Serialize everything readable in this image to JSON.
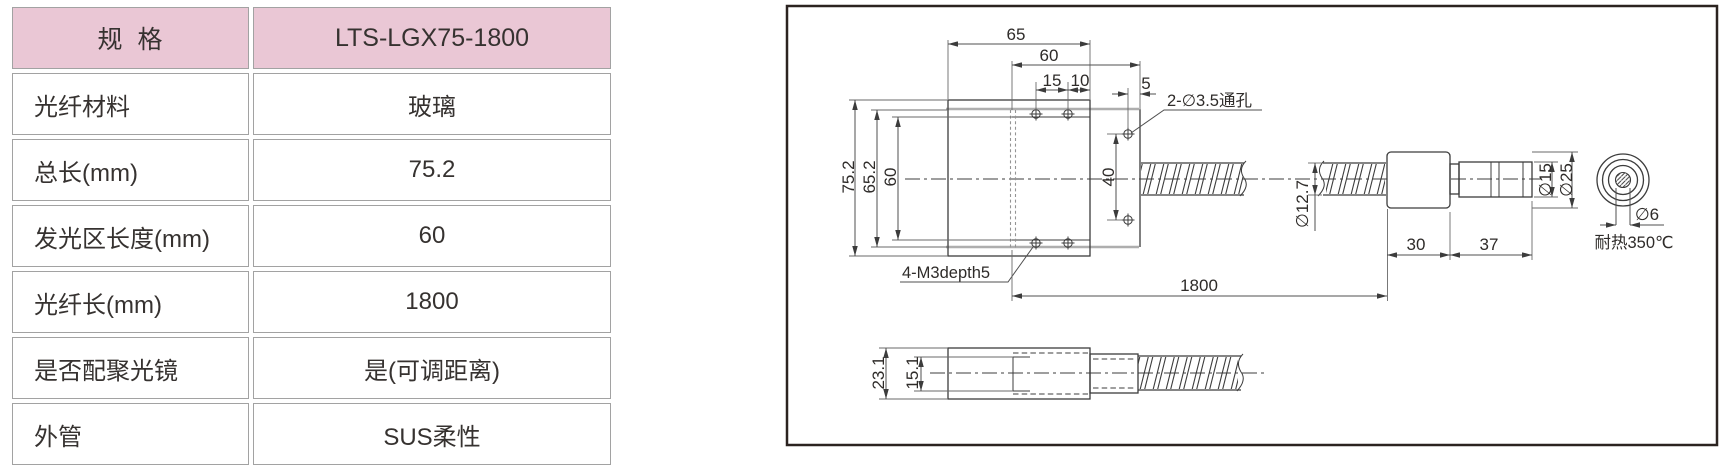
{
  "table": {
    "header_bg": "#eac7d5",
    "header": {
      "label": "规格",
      "value": "LTS-LGX75-1800"
    },
    "rows": [
      {
        "label": "光纤材料",
        "value": "玻璃"
      },
      {
        "label": "总长(mm)",
        "value": "75.2"
      },
      {
        "label": "发光区长度(mm)",
        "value": "60"
      },
      {
        "label": "光纤长(mm)",
        "value": "1800"
      },
      {
        "label": "是否配聚光镜",
        "value": "是(可调距离)"
      },
      {
        "label": "外管",
        "value": "SUS柔性"
      }
    ]
  },
  "drawing": {
    "main_view": {
      "dim_top_width": "65",
      "dim_emit_width": "60",
      "dim_hole_pitch": "15",
      "dim_hole_offset": "10",
      "dim_flange_hole_offset": "5",
      "dim_total_height": "75.2",
      "dim_inner_height": "65.2",
      "dim_emit_height": "60",
      "dim_flange_hole_pitch": "40",
      "label_through_holes": "2-∅3.5通孔",
      "label_tap_holes": "4-M3depth5",
      "dim_fiber_length": "1800",
      "dim_conduit_dia": "∅12.7",
      "dim_connector_len": "30",
      "dim_tip_len": "37",
      "dim_tip_dia": "∅15",
      "dim_connector_dia": "∅25",
      "dim_core_dia": "∅6",
      "label_heat_resist": "耐热350℃"
    },
    "side_view": {
      "dim_height": "23.1",
      "dim_inner_height": "15.1"
    }
  }
}
